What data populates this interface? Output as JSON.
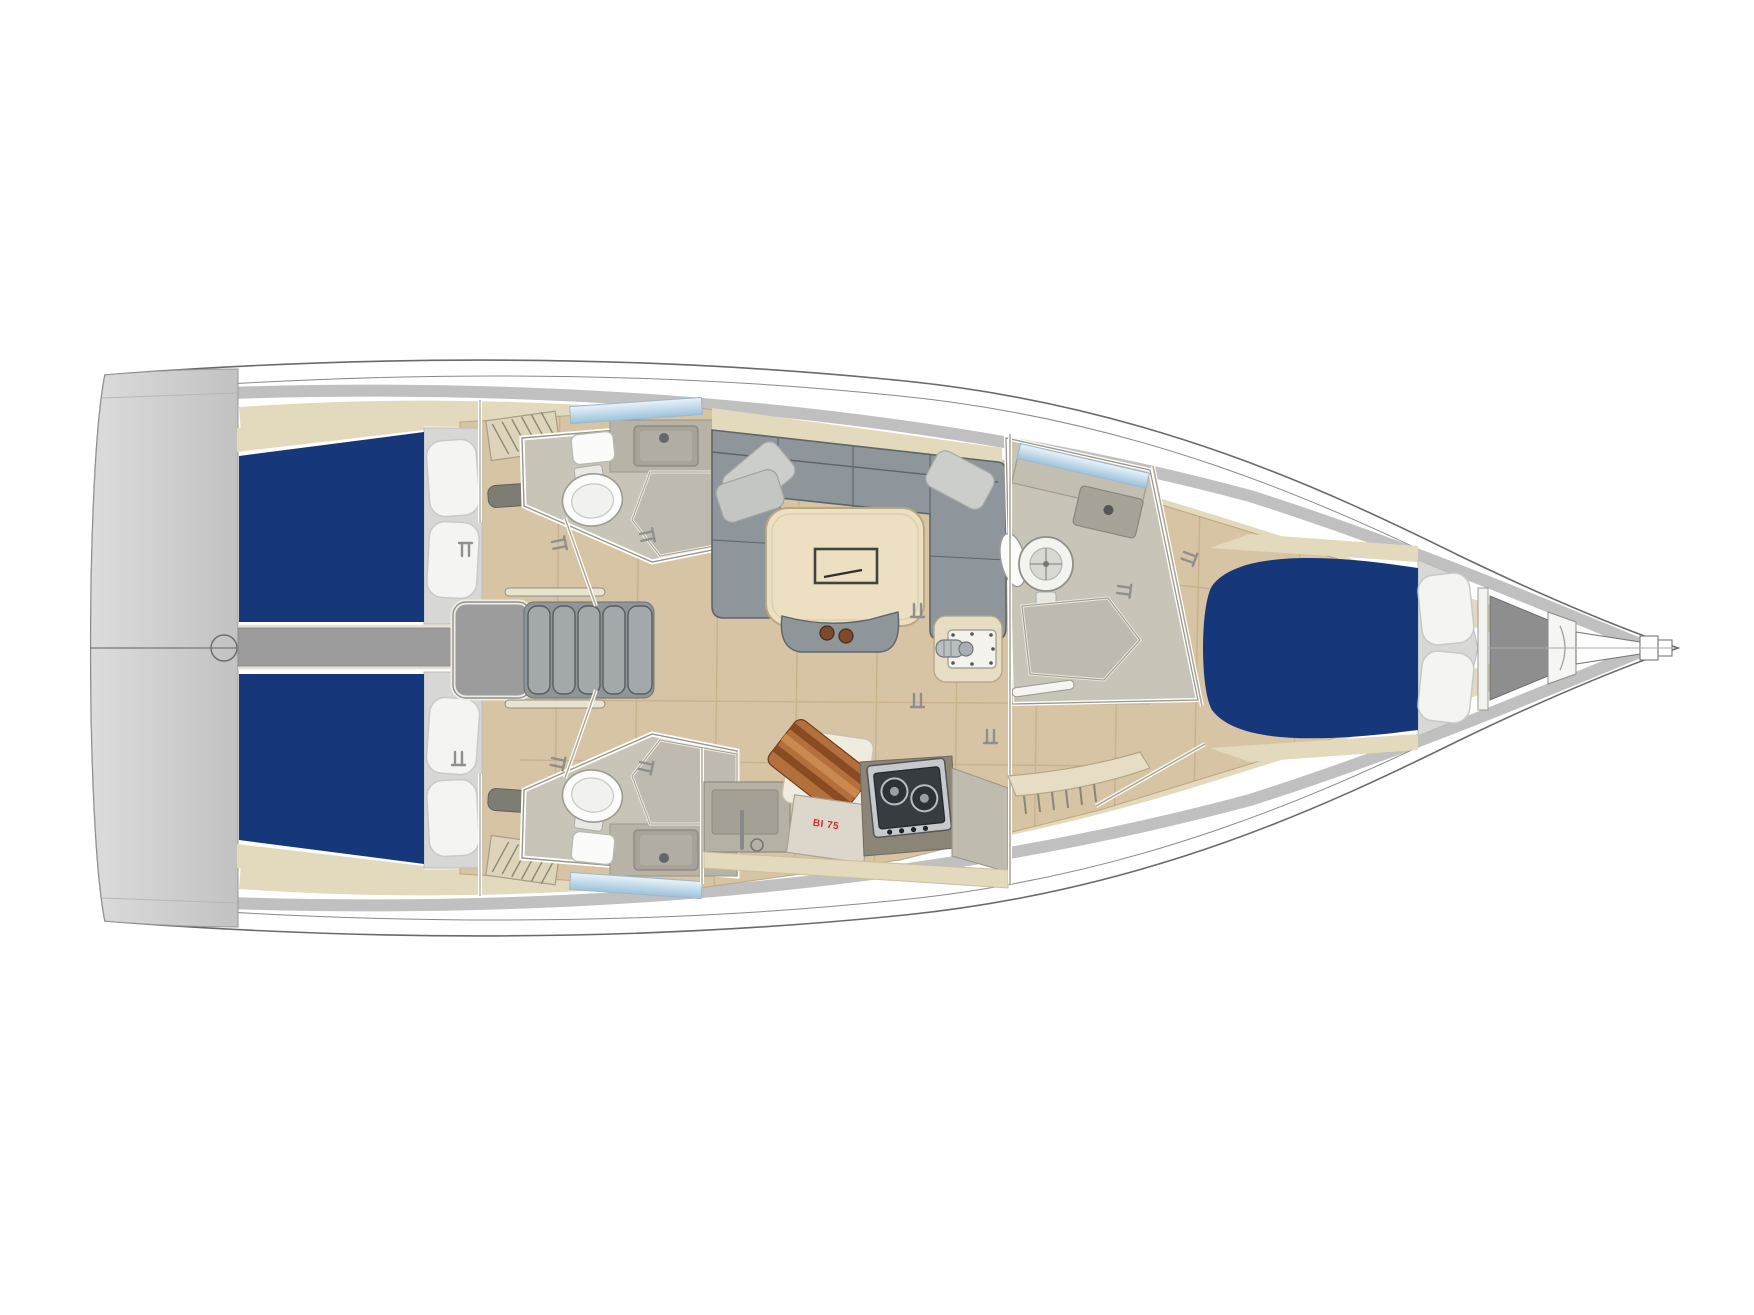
{
  "diagram": {
    "type": "sailboat-interior-floorplan-top-view",
    "orientation": "bow-right",
    "areas": [
      "transom-swim-platform",
      "aft-cabin-port",
      "aft-cabin-starboard",
      "head-port",
      "head-starboard",
      "companionway-stairs",
      "engine-corridor",
      "salon-settee",
      "salon-table",
      "mast-step",
      "galley",
      "head-forward",
      "forward-cabin",
      "anchor-locker",
      "bowsprit"
    ]
  },
  "galley": {
    "fridge_label": "BI 75"
  },
  "counts": {
    "cabins": 3,
    "heads": 3,
    "berth_cushions_blue": 3,
    "pillows_white": 6
  },
  "colors": {
    "outline": "#6a6a6a",
    "hull_white": "#ffffff",
    "deck_gray": "#c0c0c0",
    "transom_gray": "#c6c6c6",
    "liner_cream": "#e3d9bc",
    "wood_floor": "#d6c4a4",
    "wood_line": "#a9844f",
    "bed_blue": "#16387b",
    "pillow_white": "#f4f4f3",
    "sofa_gray": "#8f969b",
    "sofa_dark": "#5e6569",
    "sofa_pillow": "#cbcecb",
    "table_wood": "#ecdfc2",
    "table_edge": "#b9a87e",
    "counter_gray": "#c2bdb1",
    "basin_gray": "#a8a399",
    "shower_gray": "#bfbab0",
    "head_floor": "#c9c4b8",
    "fixture_white": "#fbfbfa",
    "fixture_stroke": "#9b9b94",
    "window_blue": "#b7d3e6",
    "stove_frame": "#c6cacc",
    "stove_dark": "#363c40",
    "board_wood": "#b4703c",
    "board_wood_dark": "#8a4a22",
    "board_wood_light": "#c9894f",
    "stair_gray": "#a3a8aa",
    "engine_gray": "#9c9c9c",
    "vent_gray": "#7d7d74",
    "anchor_gray": "#8e8e8e",
    "bench_cream": "#e6ddc4",
    "label_red": "#c9302a"
  }
}
